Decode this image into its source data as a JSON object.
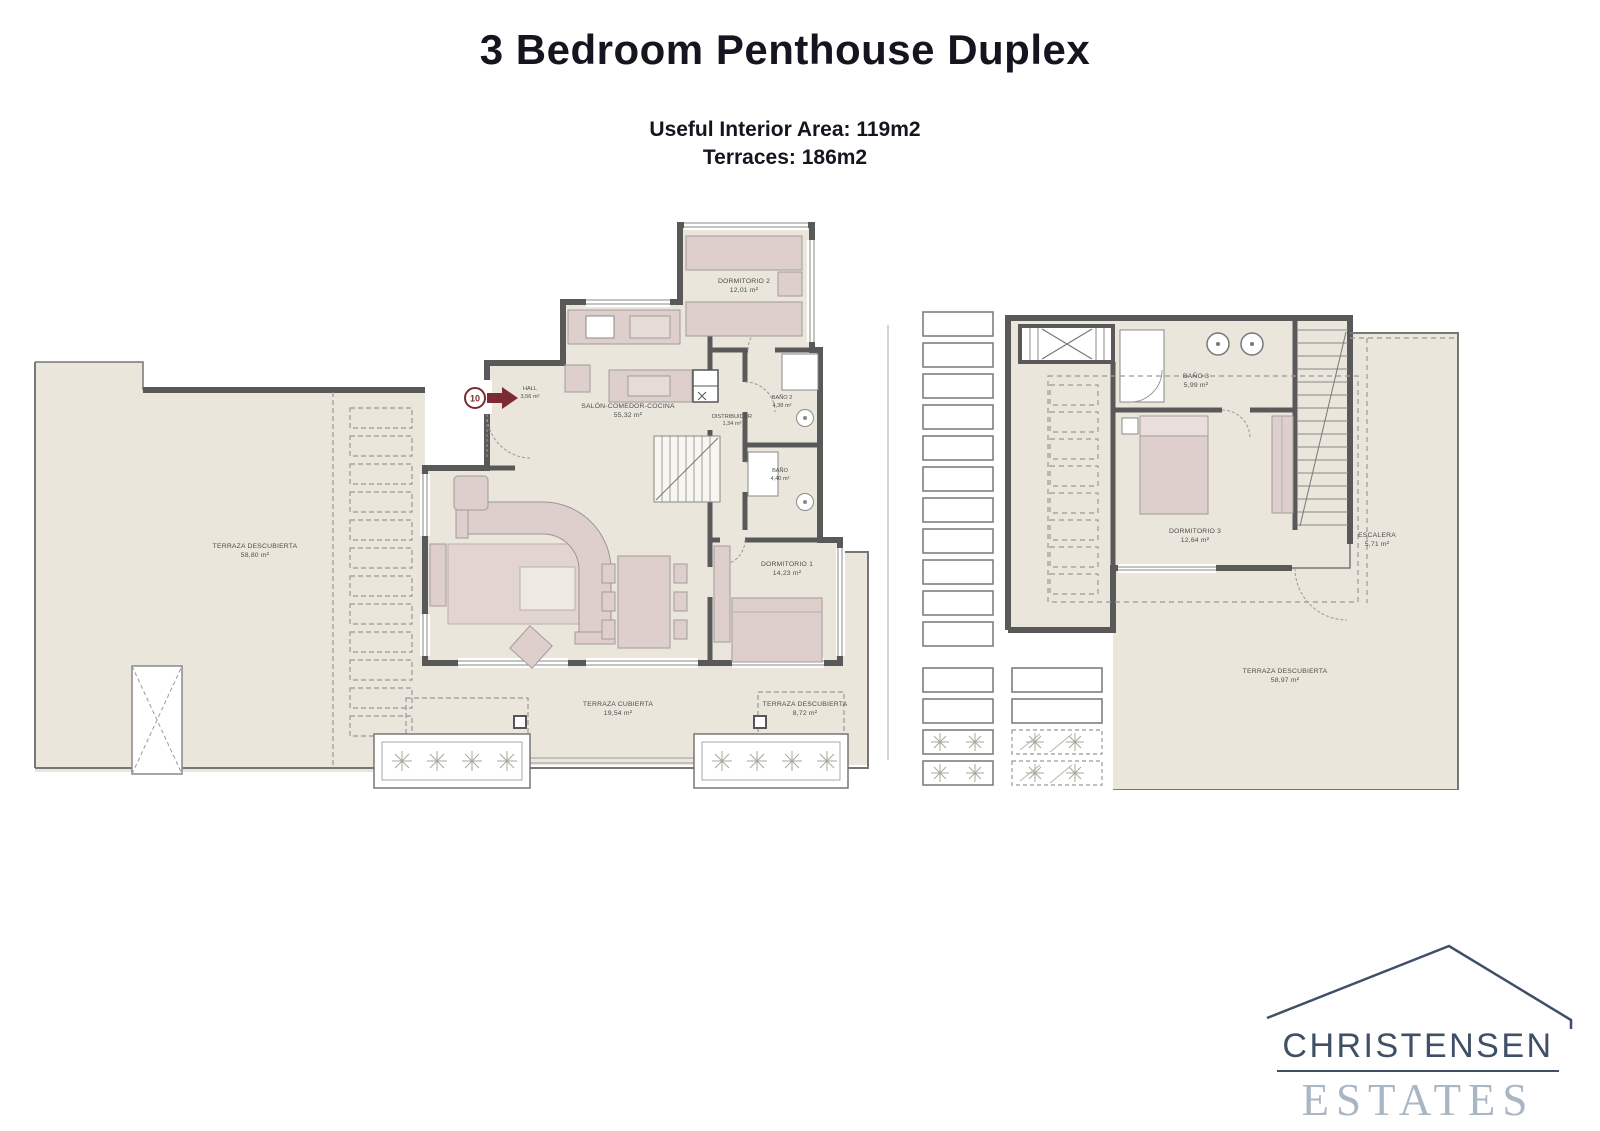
{
  "page": {
    "title": "3 Bedroom Penthouse Duplex",
    "subtitle1": "Useful Interior Area: 119m2",
    "subtitle2": "Terraces: 186m2"
  },
  "floor1": {
    "badge": "10",
    "rooms": {
      "hall": {
        "name": "HALL",
        "area": "3,56 m²"
      },
      "salon": {
        "name": "SALÓN-COMEDOR-COCINA",
        "area": "55,32 m²"
      },
      "distribuidor": {
        "name": "DISTRIBUIDOR",
        "area": "1,34 m²"
      },
      "bano2": {
        "name": "BAÑO 2",
        "area": "4,38 m²"
      },
      "bano": {
        "name": "BAÑO",
        "area": "4,40 m²"
      },
      "dorm2": {
        "name": "DORMITORIO 2",
        "area": "12,01 m²"
      },
      "dorm1": {
        "name": "DORMITORIO 1",
        "area": "14,23 m²"
      },
      "terraza": {
        "name": "TERRAZA DESCUBIERTA",
        "area": "58,80 m²"
      },
      "terrazaCub": {
        "name": "TERRAZA CUBIERTA",
        "area": "19,54 m²"
      },
      "terraza2": {
        "name": "TERRAZA DESCUBIERTA",
        "area": "8,72 m²"
      }
    }
  },
  "floor2": {
    "rooms": {
      "bano3": {
        "name": "BAÑO 3",
        "area": "5,99 m²"
      },
      "dorm3": {
        "name": "DORMITORIO 3",
        "area": "12,64 m²"
      },
      "escalera": {
        "name": "ESCALERA",
        "area": "5,71 m²"
      },
      "terraza": {
        "name": "TERRAZA DESCUBIERTA",
        "area": "58,97 m²"
      }
    }
  },
  "logo": {
    "name": "CHRISTENSEN",
    "type": "ESTATES"
  },
  "colors": {
    "floor": "#eae6db",
    "wall": "#595959",
    "furniture": "#decfcc",
    "accent_maroon": "#7c2b33",
    "logo_dark": "#3f5066",
    "logo_light": "#a9b6c3"
  }
}
